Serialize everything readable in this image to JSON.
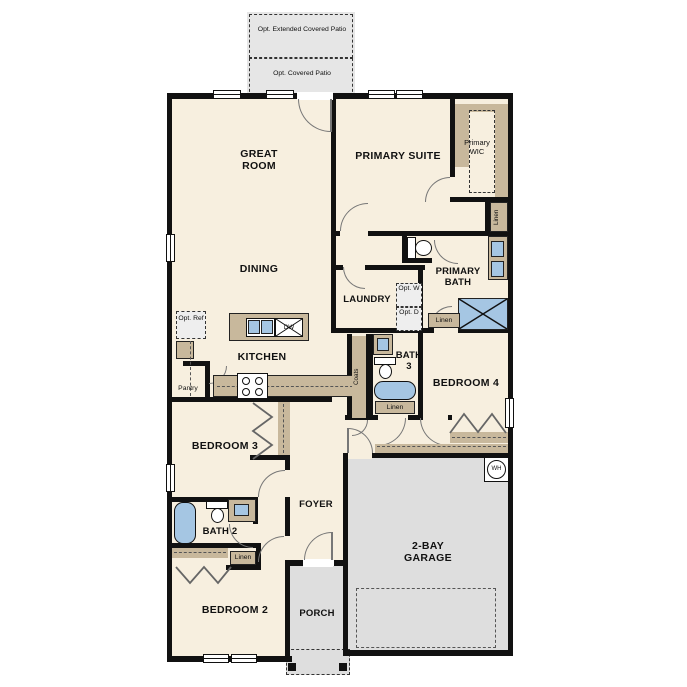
{
  "title": "Single-story floor plan",
  "rooms": {
    "great_room": "GREAT ROOM",
    "dining": "DINING",
    "kitchen": "KITCHEN",
    "primary_suite": "PRIMARY SUITE",
    "primary_wic": "Primary WIC",
    "primary_bath": "PRIMARY BATH",
    "laundry": "LAUNDRY",
    "bath3": "BATH 3",
    "bedroom4": "BEDROOM 4",
    "bedroom3": "BEDROOM 3",
    "bath2": "BATH 2",
    "bedroom2": "BEDROOM 2",
    "foyer": "FOYER",
    "porch": "PORCH",
    "garage": "2-BAY GARAGE"
  },
  "annotations": {
    "opt_extended_patio": "Opt. Extended Covered Patio",
    "opt_covered_patio": "Opt. Covered Patio",
    "opt_ref": "Opt. Ref",
    "opt_w": "Opt. W",
    "opt_d": "Opt. D",
    "pantry": "Pantry",
    "coats": "Coats",
    "linen_wic": "Linen",
    "linen_bath": "Linen",
    "linen_hall": "Linen",
    "linen_bed2": "Linen",
    "dishwasher": "DW",
    "water_heater": "WH"
  },
  "colors": {
    "wall": "#111111",
    "cream": "#f7efdf",
    "tan": "#c8b89c",
    "blue": "#a5c6e3",
    "gray": "#dedede",
    "lightgray": "#e6e6e6",
    "arc": "#777777"
  }
}
